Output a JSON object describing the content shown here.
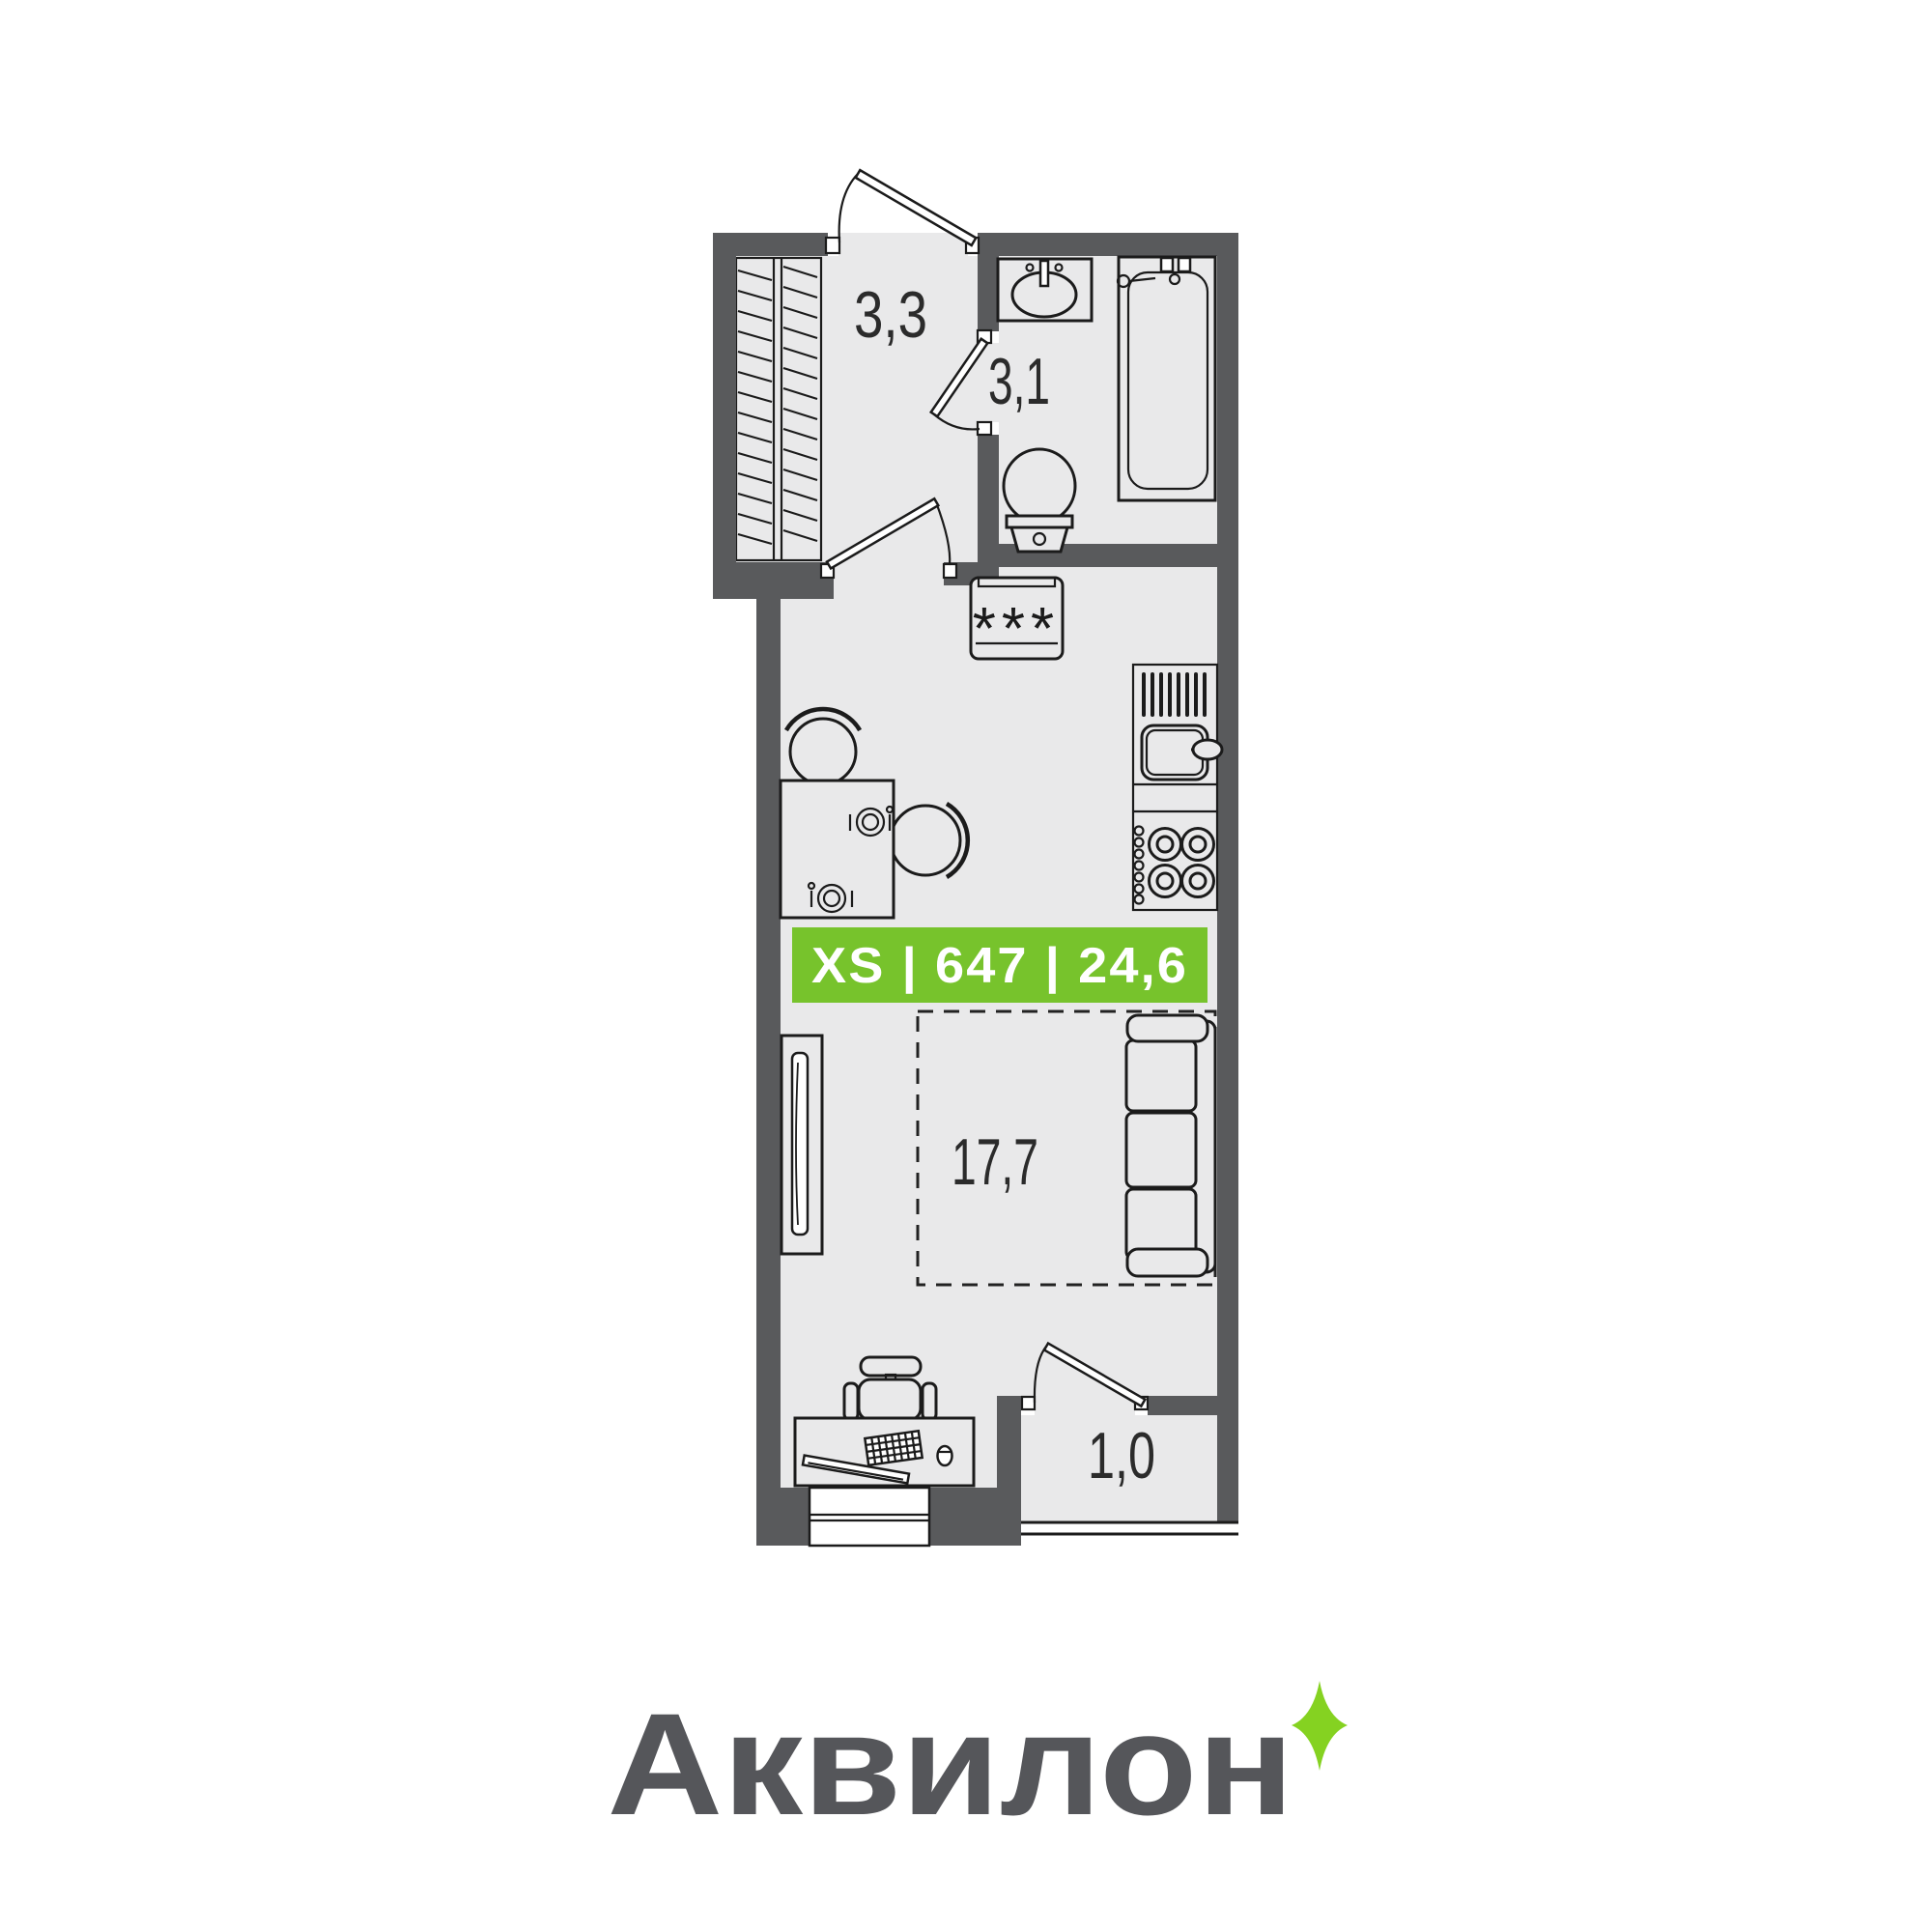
{
  "plan": {
    "rooms": {
      "entrance": {
        "area_label": "3,3"
      },
      "bathroom": {
        "area_label": "3,1"
      },
      "living": {
        "area_label": "17,7"
      },
      "balcony": {
        "area_label": "1,0"
      }
    },
    "appliances": {
      "washing_machine_label": "***"
    },
    "badge": {
      "size_class": "XS",
      "unit_number": "647",
      "total_area": "24,6",
      "text": "XS | 647 | 24,6",
      "background_color": "#77c32c",
      "text_color": "#ffffff"
    },
    "colors": {
      "wall": "#595a5c",
      "floor": "#e9e9ea",
      "outline": "#1b1b1b"
    }
  },
  "branding": {
    "logo_text": "Аквилон",
    "logo_color": "#55565a",
    "sparkle_color": "#85d221"
  }
}
